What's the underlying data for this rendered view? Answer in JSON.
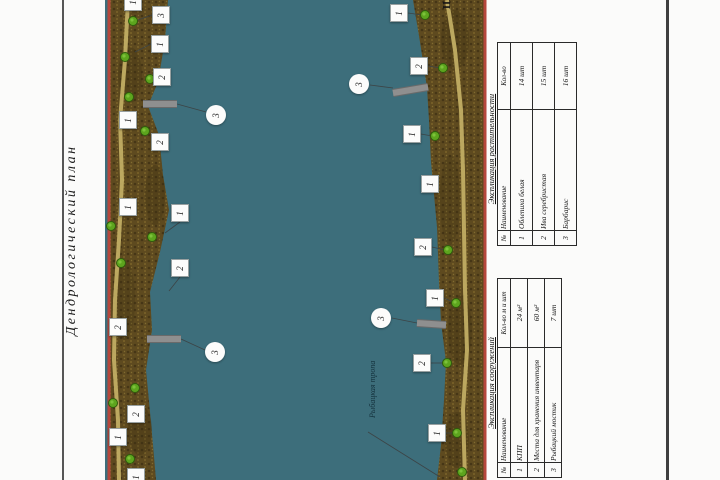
{
  "sheet": {
    "title_vertical": "Дендрологический план"
  },
  "map": {
    "water_label": "Рыбацкая тропа",
    "north_mark": "Ш",
    "colors": {
      "water": "#3d6e7b",
      "soil": "#5e4a1f",
      "soil_dark": "#463616",
      "soil_light": "#7a6329",
      "trail": "#c6b267",
      "map_border_red": "#b5473c",
      "tree_green": "#5da51e",
      "pier_grey": "#8f8f8f"
    },
    "markers": {
      "squares": [
        {
          "n": "1",
          "x": 28,
          "y": 2
        },
        {
          "n": "3",
          "x": 56,
          "y": 15
        },
        {
          "n": "1",
          "x": 55,
          "y": 44
        },
        {
          "n": "2",
          "x": 57,
          "y": 77
        },
        {
          "n": "1",
          "x": 23,
          "y": 120
        },
        {
          "n": "2",
          "x": 55,
          "y": 142
        },
        {
          "n": "1",
          "x": 23,
          "y": 207
        },
        {
          "n": "1",
          "x": 75,
          "y": 213
        },
        {
          "n": "2",
          "x": 75,
          "y": 268
        },
        {
          "n": "2",
          "x": 13,
          "y": 327
        },
        {
          "n": "2",
          "x": 31,
          "y": 414
        },
        {
          "n": "1",
          "x": 13,
          "y": 437
        },
        {
          "n": "1",
          "x": 31,
          "y": 477
        },
        {
          "n": "1",
          "x": 294,
          "y": 13
        },
        {
          "n": "2",
          "x": 314,
          "y": 66
        },
        {
          "n": "1",
          "x": 307,
          "y": 134
        },
        {
          "n": "1",
          "x": 325,
          "y": 184
        },
        {
          "n": "2",
          "x": 318,
          "y": 247
        },
        {
          "n": "1",
          "x": 330,
          "y": 298
        },
        {
          "n": "2",
          "x": 317,
          "y": 363
        },
        {
          "n": "1",
          "x": 332,
          "y": 433
        }
      ],
      "circles": [
        {
          "n": "3",
          "x": 111,
          "y": 115
        },
        {
          "n": "3",
          "x": 110,
          "y": 352
        },
        {
          "n": "3",
          "x": 254,
          "y": 84
        },
        {
          "n": "3",
          "x": 276,
          "y": 318
        }
      ]
    },
    "piers": [
      {
        "x1": 38,
        "y1": 104,
        "x2": 72,
        "y2": 104
      },
      {
        "x1": 42,
        "y1": 339,
        "x2": 76,
        "y2": 339
      },
      {
        "x1": 288,
        "y1": 93,
        "x2": 323,
        "y2": 87
      },
      {
        "x1": 312,
        "y1": 323,
        "x2": 341,
        "y2": 325
      }
    ],
    "leaders": [
      [
        72,
        104,
        101,
        112
      ],
      [
        76,
        339,
        100,
        350
      ],
      [
        288,
        88,
        265,
        85
      ],
      [
        312,
        323,
        287,
        318
      ],
      [
        47,
        15,
        33,
        20
      ],
      [
        46,
        44,
        30,
        52
      ],
      [
        48,
        77,
        46,
        79
      ],
      [
        75,
        222,
        60,
        233
      ],
      [
        75,
        277,
        64,
        291
      ],
      [
        303,
        13,
        317,
        15
      ],
      [
        323,
        66,
        335,
        68
      ],
      [
        316,
        134,
        327,
        136
      ],
      [
        327,
        247,
        340,
        250
      ],
      [
        339,
        298,
        348,
        302
      ],
      [
        326,
        363,
        339,
        363
      ],
      [
        341,
        433,
        352,
        433
      ],
      [
        263,
        432,
        335,
        477
      ]
    ],
    "trees": [
      {
        "x": 28,
        "y": 21
      },
      {
        "x": 20,
        "y": 57
      },
      {
        "x": 45,
        "y": 79
      },
      {
        "x": 24,
        "y": 97
      },
      {
        "x": 40,
        "y": 131
      },
      {
        "x": 6,
        "y": 226
      },
      {
        "x": 47,
        "y": 237
      },
      {
        "x": 16,
        "y": 263
      },
      {
        "x": 30,
        "y": 388
      },
      {
        "x": 8,
        "y": 403
      },
      {
        "x": 25,
        "y": 459
      },
      {
        "x": 320,
        "y": 15
      },
      {
        "x": 338,
        "y": 68
      },
      {
        "x": 330,
        "y": 136
      },
      {
        "x": 343,
        "y": 250
      },
      {
        "x": 351,
        "y": 303
      },
      {
        "x": 342,
        "y": 363
      },
      {
        "x": 352,
        "y": 433
      },
      {
        "x": 357,
        "y": 472
      }
    ]
  },
  "tables": [
    {
      "title": "Экспликация растительности",
      "headers": [
        "№",
        "Наименование",
        "Кол-во"
      ],
      "rows": [
        [
          "1",
          "Облепиха белая",
          "14 шт"
        ],
        [
          "2",
          "Ива серебристая",
          "15 шт"
        ],
        [
          "3",
          "Барбарис",
          "16 шт"
        ]
      ]
    },
    {
      "title": "Экспликация сооружений",
      "headers": [
        "№",
        "Наименование",
        "Кол-во м и шт"
      ],
      "rows": [
        [
          "1",
          "КПП",
          "24 м²"
        ],
        [
          "2",
          "Места для хранения инвентаря",
          "60 м²"
        ],
        [
          "3",
          "Рыбацкий мостик",
          "7 шт"
        ]
      ]
    }
  ]
}
